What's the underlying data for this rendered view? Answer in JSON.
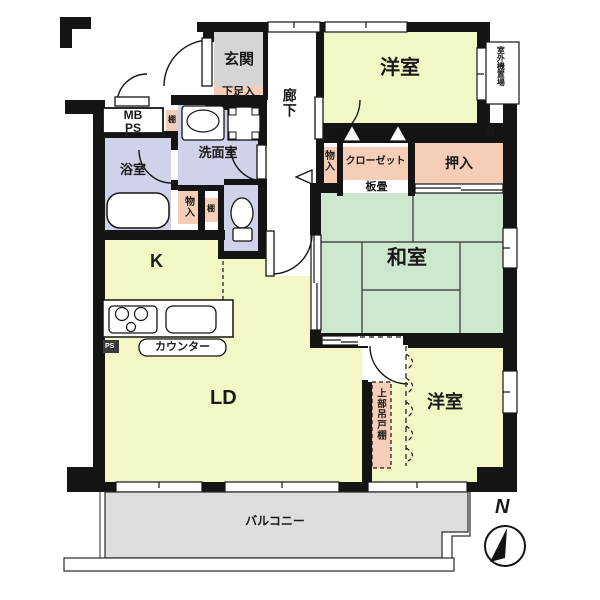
{
  "title": "apartment-floor-plan",
  "labels": {
    "genkan": "玄関",
    "shoe_box": "下足入",
    "hallway": "廊下",
    "bedroom1": "洋室",
    "outdoor_unit": "室外機置場",
    "shelf": "棚",
    "storage": "物入",
    "closet": "クローゼット",
    "oshiire": "押入",
    "itadatami": "板畳",
    "washitsu": "和室",
    "mb_ps": "MB\nPS",
    "washroom": "洗面室",
    "bathroom": "浴室",
    "kitchen": "K",
    "counter": "カウンター",
    "ps": "PS",
    "living_dining": "LD",
    "hanging_cupboard": "上部吊戸棚",
    "bedroom2": "洋室",
    "balcony": "バルコニー",
    "north": "N"
  },
  "colors": {
    "wall": "#141414",
    "room_yellow": "#F3F6C5",
    "tatami_green": "#CDE7CE",
    "wet_area_lavender": "#CFD2E8",
    "storage_pink": "#F6CEB8",
    "entry_gray": "#D5D5D5",
    "balcony_gray": "#DEDEDE"
  }
}
